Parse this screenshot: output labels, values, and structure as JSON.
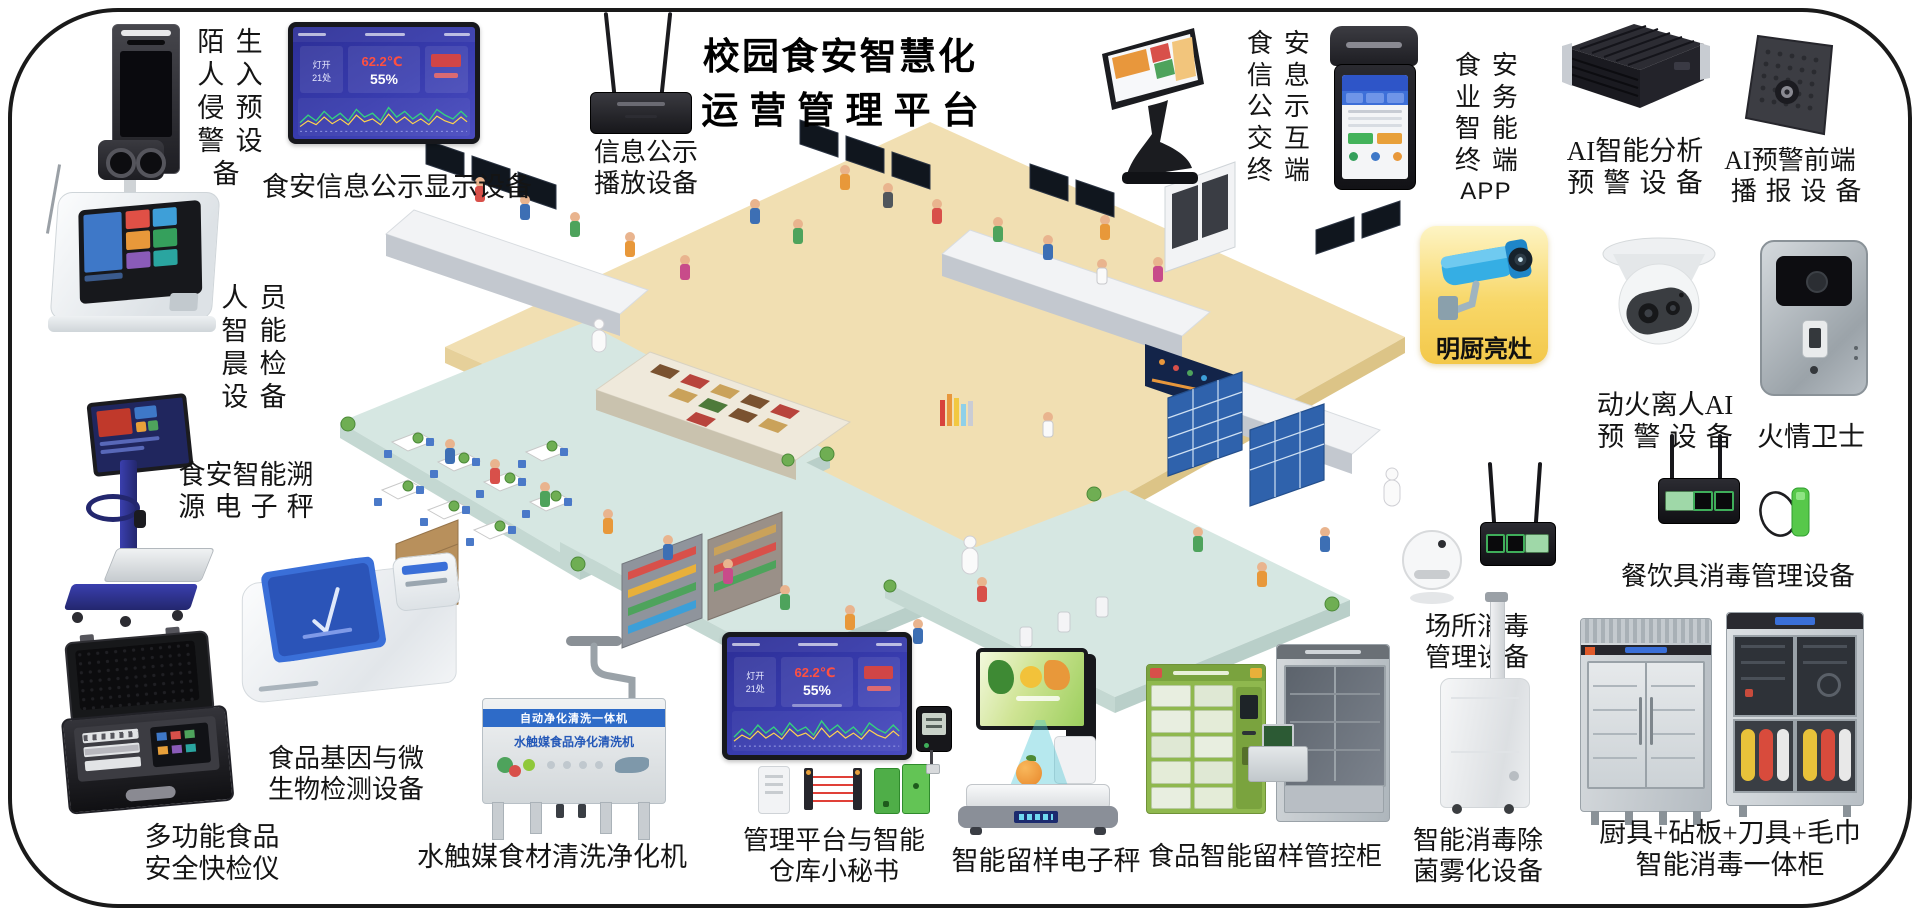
{
  "title": {
    "line1": "校园食安智慧化",
    "line2": "运营管理平台"
  },
  "dashboard": {
    "light_label": "灯开",
    "light_value": "21处",
    "temperature": "62.2℃",
    "humidity": "55%"
  },
  "washer_banner": {
    "line1": "自动净化清洗一体机",
    "line2": "水触媒食品净化清洗机"
  },
  "labels": {
    "stranger": [
      "陌生",
      "人入",
      "侵预",
      "警设",
      "备"
    ],
    "display_board": [
      "食安信息公示显示设备"
    ],
    "info_player": [
      "信息公示",
      "播放设备"
    ],
    "kiosk": [
      "食安",
      "信息",
      "公示",
      "交互",
      "终端"
    ],
    "pos_app": [
      "食安",
      "业务",
      "智能",
      "终端",
      "APP"
    ],
    "ai_analysis": [
      "AI智能分析",
      "预警设备"
    ],
    "ai_broadcast": [
      "AI预警前端",
      "播报设备"
    ],
    "bright_kitchen": [
      "明厨亮灶"
    ],
    "fire_ai": [
      "动火离人AI",
      "预警设备"
    ],
    "fire_guard": [
      "火情卫士"
    ],
    "tableware_disinfect": [
      "餐饮具消毒管理设备"
    ],
    "venue_disinfect": [
      "场所消毒",
      "管理设备"
    ],
    "fogger": [
      "智能消毒除",
      "菌雾化设备"
    ],
    "combo_cabinet": [
      "厨具+砧板+刀具+毛巾",
      "智能消毒一体柜"
    ],
    "sample_cabinet": [
      "食品智能留样管控柜"
    ],
    "sample_scale": [
      "智能留样电子秤"
    ],
    "mgmt_platform": [
      "管理平台与智能",
      "仓库小秘书"
    ],
    "washer": [
      "水触媒食材清洗净化机"
    ],
    "rapid_tester": [
      "多功能食品",
      "安全快检仪"
    ],
    "gene_detector": [
      "食品基因与微",
      "生物检测设备"
    ],
    "trace_scale": [
      "食安智能溯",
      "源电子秤"
    ],
    "morning_check": [
      "人员",
      "智能",
      "晨检",
      "设备"
    ]
  },
  "accent_colors": {
    "dashboard_blue": "#32359e",
    "alert_red": "#e0453a",
    "bright_kitchen_yellow": "#f6cc52",
    "camera_blue": "#35aee4",
    "cabinet_green": "#8fb84e",
    "floor_beige": "#f1dfb2",
    "floor_teal": "#d6e7e2"
  }
}
